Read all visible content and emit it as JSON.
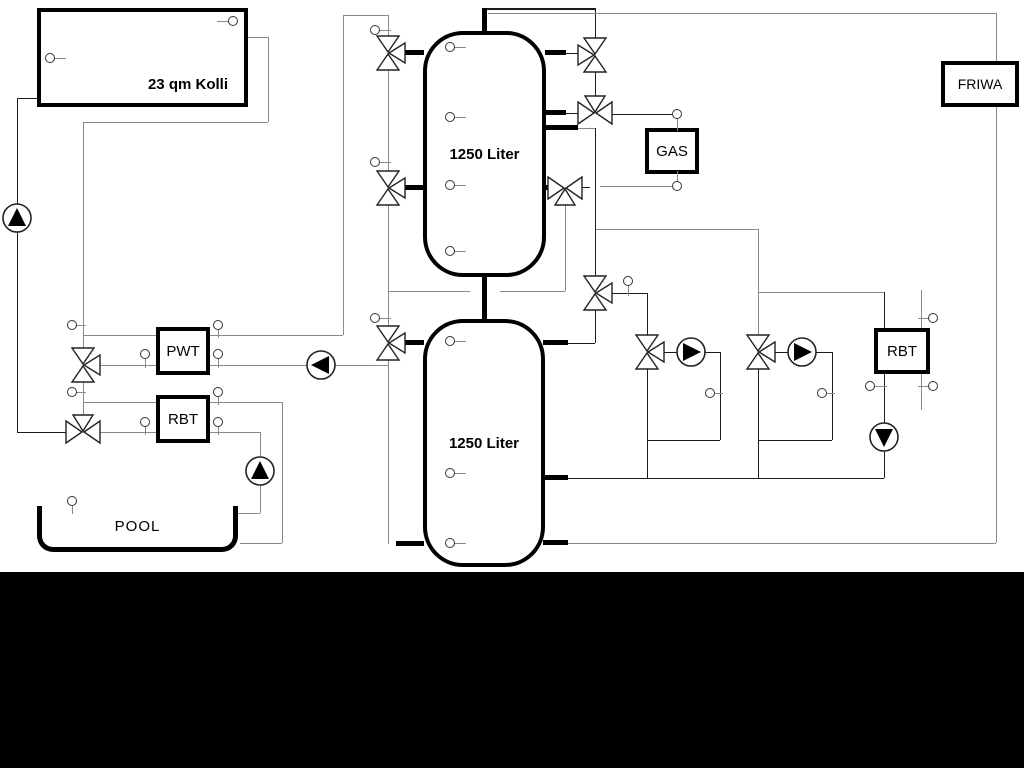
{
  "labels": {
    "collector": "23 qm Kolli",
    "tank_top": "1250 Liter",
    "tank_bottom": "1250 Liter",
    "gas": "GAS",
    "friwa": "FRIWA",
    "pwt": "PWT",
    "rbt_left": "RBT",
    "rbt_right": "RBT",
    "pool": "POOL"
  },
  "colors": {
    "line_black": "#1c1c1c",
    "line_gray": "#8a8a8a",
    "stub_black": "#000000",
    "background": "#ffffff",
    "letterbox": "#000000"
  },
  "diagram": {
    "lines": [
      {
        "n": "collector-flow-pipe",
        "x": 17,
        "y": 98,
        "len": 20,
        "o": "h",
        "c": "k"
      },
      {
        "n": "collector-flow-pipe",
        "x": 17,
        "y": 98,
        "len": 334,
        "o": "v",
        "c": "k"
      },
      {
        "n": "collector-flow-pipe",
        "x": 17,
        "y": 432,
        "len": 49,
        "o": "h",
        "c": "k"
      },
      {
        "n": "collector-return-pipe",
        "x": 248,
        "y": 37,
        "len": 20,
        "o": "h",
        "c": "g"
      },
      {
        "n": "collector-return-pipe",
        "x": 268,
        "y": 37,
        "len": 85,
        "o": "v",
        "c": "g"
      },
      {
        "n": "collector-return-pipe",
        "x": 83,
        "y": 122,
        "len": 185,
        "o": "h",
        "c": "g"
      },
      {
        "n": "collector-return-pipe",
        "x": 83,
        "y": 122,
        "len": 227,
        "o": "v",
        "c": "g"
      },
      {
        "n": "left-riser-pipe",
        "x": 83,
        "y": 381,
        "len": 35,
        "o": "v",
        "c": "g"
      },
      {
        "n": "pwt-top-pipe",
        "x": 83,
        "y": 335,
        "len": 73,
        "o": "h",
        "c": "g"
      },
      {
        "n": "pwt-top-pipe",
        "x": 210,
        "y": 335,
        "len": 133,
        "o": "h",
        "c": "g"
      },
      {
        "n": "solar-to-tank-pipe",
        "x": 343,
        "y": 15,
        "len": 320,
        "o": "v",
        "c": "g"
      },
      {
        "n": "solar-to-tank-pipe",
        "x": 343,
        "y": 15,
        "len": 45,
        "o": "h",
        "c": "g"
      },
      {
        "n": "pwt-bottom-pipe",
        "x": 99,
        "y": 365,
        "len": 57,
        "o": "h",
        "c": "g"
      },
      {
        "n": "pwt-bottom-pipe",
        "x": 210,
        "y": 365,
        "len": 97,
        "o": "h",
        "c": "g"
      },
      {
        "n": "pwt-bottom-pipe",
        "x": 335,
        "y": 365,
        "len": 53,
        "o": "h",
        "c": "g"
      },
      {
        "n": "rbt-top-pipe",
        "x": 83,
        "y": 402,
        "len": 73,
        "o": "h",
        "c": "g"
      },
      {
        "n": "rbt-top-pipe",
        "x": 210,
        "y": 402,
        "len": 72,
        "o": "h",
        "c": "g"
      },
      {
        "n": "pool-return-pipe",
        "x": 282,
        "y": 402,
        "len": 141,
        "o": "v",
        "c": "g"
      },
      {
        "n": "pool-return-pipe",
        "x": 240,
        "y": 543,
        "len": 42,
        "o": "h",
        "c": "g"
      },
      {
        "n": "rbt-bottom-pipe",
        "x": 99,
        "y": 432,
        "len": 57,
        "o": "h",
        "c": "g"
      },
      {
        "n": "rbt-bottom-pipe",
        "x": 210,
        "y": 432,
        "len": 50,
        "o": "h",
        "c": "g"
      },
      {
        "n": "pool-supply-pipe",
        "x": 260,
        "y": 432,
        "len": 81,
        "o": "v",
        "c": "g"
      },
      {
        "n": "pool-supply-pipe",
        "x": 238,
        "y": 513,
        "len": 22,
        "o": "h",
        "c": "g"
      },
      {
        "n": "tank-left-riser",
        "x": 388,
        "y": 15,
        "len": 22,
        "o": "v",
        "c": "g"
      },
      {
        "n": "tank-left-riser",
        "x": 388,
        "y": 69,
        "len": 103,
        "o": "v",
        "c": "g"
      },
      {
        "n": "tank-left-riser",
        "x": 388,
        "y": 204,
        "len": 123,
        "o": "v",
        "c": "g"
      },
      {
        "n": "tank-left-riser",
        "x": 388,
        "y": 359,
        "len": 185,
        "o": "v",
        "c": "g"
      },
      {
        "n": "inter-tank-pipe",
        "x": 388,
        "y": 291,
        "len": 82,
        "o": "h",
        "c": "g"
      },
      {
        "n": "inter-tank-pipe",
        "x": 500,
        "y": 291,
        "len": 65,
        "o": "h",
        "c": "g"
      },
      {
        "n": "gas-return-riser",
        "x": 565,
        "y": 205,
        "len": 86,
        "o": "v",
        "c": "g"
      },
      {
        "n": "tank-top-pipe",
        "x": 484,
        "y": 9,
        "len": 112,
        "o": "h",
        "c": "k",
        "t": 2
      },
      {
        "n": "tank-top-pipe",
        "x": 595,
        "y": 10,
        "len": 28,
        "o": "v",
        "c": "k"
      },
      {
        "n": "friwa-supply-pipe",
        "x": 488,
        "y": 13,
        "len": 508,
        "o": "h",
        "c": "g"
      },
      {
        "n": "friwa-supply-pipe",
        "x": 996,
        "y": 13,
        "len": 48,
        "o": "v",
        "c": "g"
      },
      {
        "n": "friwa-return-pipe",
        "x": 996,
        "y": 107,
        "len": 436,
        "o": "v",
        "c": "g"
      },
      {
        "n": "friwa-return-pipe",
        "x": 567,
        "y": 543,
        "len": 429,
        "o": "h",
        "c": "g"
      },
      {
        "n": "valve-port-pipe",
        "x": 566,
        "y": 53,
        "len": 12,
        "o": "h",
        "c": "k"
      },
      {
        "n": "right-valve-riser",
        "x": 595,
        "y": 72,
        "len": 25,
        "o": "v",
        "c": "k"
      },
      {
        "n": "valve-port-pipe",
        "x": 566,
        "y": 113,
        "len": 12,
        "o": "h",
        "c": "k"
      },
      {
        "n": "gas-supply-pipe",
        "x": 612,
        "y": 114,
        "len": 60,
        "o": "h",
        "c": "k"
      },
      {
        "n": "gas-return-pipe",
        "x": 582,
        "y": 187,
        "len": 8,
        "o": "h",
        "c": "k"
      },
      {
        "n": "gas-return-pipe",
        "x": 600,
        "y": 186,
        "len": 72,
        "o": "h",
        "c": "g"
      },
      {
        "n": "tank2-supply-riser",
        "x": 595,
        "y": 128,
        "len": 149,
        "o": "v",
        "c": "k"
      },
      {
        "n": "tank2-supply-riser",
        "x": 578,
        "y": 128,
        "len": 17,
        "o": "h",
        "c": "g"
      },
      {
        "n": "heating-branch-pipe",
        "x": 596,
        "y": 229,
        "len": 162,
        "o": "h",
        "c": "g"
      },
      {
        "n": "heating-branch-pipe",
        "x": 758,
        "y": 229,
        "len": 107,
        "o": "v",
        "c": "g"
      },
      {
        "n": "rbt2-supply-pipe",
        "x": 758,
        "y": 292,
        "len": 126,
        "o": "h",
        "c": "g"
      },
      {
        "n": "rbt2-riser",
        "x": 884,
        "y": 292,
        "len": 186,
        "o": "v",
        "c": "k"
      },
      {
        "n": "tank2-supply-pipe",
        "x": 595,
        "y": 309,
        "len": 34,
        "o": "v",
        "c": "k"
      },
      {
        "n": "tank2-supply-pipe",
        "x": 567,
        "y": 343,
        "len": 28,
        "o": "h",
        "c": "k"
      },
      {
        "n": "heating1-supply-pipe",
        "x": 612,
        "y": 293,
        "len": 35,
        "o": "h",
        "c": "k"
      },
      {
        "n": "heating1-supply-pipe",
        "x": 647,
        "y": 293,
        "len": 43,
        "o": "v",
        "c": "k"
      },
      {
        "n": "pump1-inlet-pipe",
        "x": 664,
        "y": 352,
        "len": 13,
        "o": "h",
        "c": "k"
      },
      {
        "n": "pump1-outlet-pipe",
        "x": 705,
        "y": 352,
        "len": 15,
        "o": "h",
        "c": "k"
      },
      {
        "n": "pump1-loop-pipe",
        "x": 720,
        "y": 352,
        "len": 88,
        "o": "v",
        "c": "k"
      },
      {
        "n": "pump1-loop-pipe",
        "x": 647,
        "y": 440,
        "len": 73,
        "o": "h",
        "c": "k"
      },
      {
        "n": "heating1-return-riser",
        "x": 647,
        "y": 368,
        "len": 110,
        "o": "v",
        "c": "k"
      },
      {
        "n": "pump2-inlet-pipe",
        "x": 775,
        "y": 352,
        "len": 13,
        "o": "h",
        "c": "k"
      },
      {
        "n": "pump2-outlet-pipe",
        "x": 816,
        "y": 352,
        "len": 16,
        "o": "h",
        "c": "k"
      },
      {
        "n": "pump2-loop-pipe",
        "x": 832,
        "y": 352,
        "len": 88,
        "o": "v",
        "c": "k"
      },
      {
        "n": "pump2-loop-pipe",
        "x": 758,
        "y": 440,
        "len": 74,
        "o": "h",
        "c": "k"
      },
      {
        "n": "heating2-return-riser",
        "x": 758,
        "y": 368,
        "len": 110,
        "o": "v",
        "c": "k"
      },
      {
        "n": "tank2-return-pipe",
        "x": 567,
        "y": 478,
        "len": 317,
        "o": "h",
        "c": "k"
      },
      {
        "n": "friwa-cold-pipe",
        "x": 921,
        "y": 290,
        "len": 120,
        "o": "v",
        "c": "g"
      }
    ],
    "stubs": [
      {
        "n": "tank1-stub",
        "x": 403,
        "y": 50,
        "w": 21,
        "h": 5
      },
      {
        "n": "tank1-stub",
        "x": 403,
        "y": 185,
        "w": 21,
        "h": 5
      },
      {
        "n": "tank1-stub",
        "x": 545,
        "y": 50,
        "w": 21,
        "h": 5
      },
      {
        "n": "tank1-stub",
        "x": 545,
        "y": 110,
        "w": 21,
        "h": 5
      },
      {
        "n": "tank1-stub",
        "x": 545,
        "y": 125,
        "w": 33,
        "h": 5
      },
      {
        "n": "tank1-stub",
        "x": 545,
        "y": 185,
        "w": 11,
        "h": 5
      },
      {
        "n": "tank1-top-stub",
        "x": 482,
        "y": 8,
        "w": 5,
        "h": 26
      },
      {
        "n": "tank-connector-stub",
        "x": 482,
        "y": 275,
        "w": 5,
        "h": 46
      },
      {
        "n": "tank2-stub",
        "x": 402,
        "y": 340,
        "w": 22,
        "h": 5
      },
      {
        "n": "tank2-stub",
        "x": 396,
        "y": 541,
        "w": 28,
        "h": 5
      },
      {
        "n": "tank2-stub",
        "x": 543,
        "y": 340,
        "w": 25,
        "h": 5
      },
      {
        "n": "tank2-stub",
        "x": 543,
        "y": 475,
        "w": 25,
        "h": 5
      },
      {
        "n": "tank2-stub",
        "x": 543,
        "y": 540,
        "w": 25,
        "h": 5
      }
    ],
    "valves": [
      {
        "n": "tank1-left-top-valve",
        "x": 388,
        "y": 53,
        "type": "v-right"
      },
      {
        "n": "tank1-left-mid-valve",
        "x": 388,
        "y": 188,
        "type": "v-right"
      },
      {
        "n": "tank2-left-valve",
        "x": 388,
        "y": 343,
        "type": "v-right"
      },
      {
        "n": "pwt-supply-valve",
        "x": 83,
        "y": 365,
        "type": "v-right"
      },
      {
        "n": "pool-supply-valve",
        "x": 83,
        "y": 432,
        "type": "h-top"
      },
      {
        "n": "tank1-right-top-valve",
        "x": 595,
        "y": 55,
        "type": "v-left"
      },
      {
        "n": "gas-supply-valve",
        "x": 595,
        "y": 113,
        "type": "h-top"
      },
      {
        "n": "gas-return-valve",
        "x": 565,
        "y": 188,
        "type": "h-bottom"
      },
      {
        "n": "tank2-supply-valve",
        "x": 595,
        "y": 293,
        "type": "v-right"
      },
      {
        "n": "heating-valve-1",
        "x": 647,
        "y": 352,
        "type": "v-right"
      },
      {
        "n": "heating-valve-2",
        "x": 758,
        "y": 352,
        "type": "v-right"
      }
    ],
    "pumps": [
      {
        "n": "solar-pump",
        "x": 17,
        "y": 218,
        "dir": "up"
      },
      {
        "n": "pwt-pump",
        "x": 321,
        "y": 365,
        "dir": "left"
      },
      {
        "n": "pool-pump",
        "x": 260,
        "y": 471,
        "dir": "up"
      },
      {
        "n": "heating-pump-1",
        "x": 691,
        "y": 352,
        "dir": "right"
      },
      {
        "n": "heating-pump-2",
        "x": 802,
        "y": 352,
        "dir": "right"
      },
      {
        "n": "rbt-return-pump",
        "x": 884,
        "y": 437,
        "dir": "down"
      }
    ],
    "sensors": [
      {
        "n": "collector-sensor",
        "x": 50,
        "y": 58,
        "stem": "r",
        "len": 8
      },
      {
        "n": "collector-sensor",
        "x": 233,
        "y": 21,
        "stem": "l",
        "len": 8
      },
      {
        "n": "riser-sensor",
        "x": 72,
        "y": 325,
        "stem": "r",
        "len": 6
      },
      {
        "n": "pwt-sensor",
        "x": 218,
        "y": 325,
        "stem": "d",
        "len": 5
      },
      {
        "n": "pwt-sensor",
        "x": 145,
        "y": 354,
        "stem": "d",
        "len": 6
      },
      {
        "n": "pwt-sensor",
        "x": 218,
        "y": 354,
        "stem": "d",
        "len": 6
      },
      {
        "n": "riser-sensor",
        "x": 72,
        "y": 392,
        "stem": "r",
        "len": 6
      },
      {
        "n": "rbt-sensor",
        "x": 218,
        "y": 392,
        "stem": "d",
        "len": 5
      },
      {
        "n": "rbt-sensor",
        "x": 145,
        "y": 422,
        "stem": "d",
        "len": 5
      },
      {
        "n": "rbt-sensor",
        "x": 218,
        "y": 422,
        "stem": "d",
        "len": 5
      },
      {
        "n": "pool-sensor",
        "x": 72,
        "y": 501,
        "stem": "d",
        "len": 5
      },
      {
        "n": "riser-sensor",
        "x": 375,
        "y": 30,
        "stem": "r",
        "len": 8
      },
      {
        "n": "riser-sensor",
        "x": 375,
        "y": 162,
        "stem": "r",
        "len": 8
      },
      {
        "n": "riser-sensor",
        "x": 375,
        "y": 318,
        "stem": "r",
        "len": 8
      },
      {
        "n": "tank1-sensor",
        "x": 450,
        "y": 47,
        "stem": "r",
        "len": 8
      },
      {
        "n": "tank1-sensor",
        "x": 450,
        "y": 117,
        "stem": "r",
        "len": 8
      },
      {
        "n": "tank1-sensor",
        "x": 450,
        "y": 185,
        "stem": "r",
        "len": 8
      },
      {
        "n": "tank1-sensor",
        "x": 450,
        "y": 251,
        "stem": "r",
        "len": 8
      },
      {
        "n": "tank2-sensor",
        "x": 450,
        "y": 341,
        "stem": "r",
        "len": 8
      },
      {
        "n": "tank2-sensor",
        "x": 450,
        "y": 473,
        "stem": "r",
        "len": 8
      },
      {
        "n": "tank2-sensor",
        "x": 450,
        "y": 543,
        "stem": "r",
        "len": 8
      },
      {
        "n": "valve-sensor",
        "x": 628,
        "y": 281,
        "stem": "d",
        "len": 7
      },
      {
        "n": "gas-top-sensor",
        "x": 677,
        "y": 114,
        "stem": "d",
        "len": 9
      },
      {
        "n": "gas-bottom-sensor",
        "x": 677,
        "y": 186,
        "stem": "u",
        "len": 7
      },
      {
        "n": "heating1-sensor",
        "x": 710,
        "y": 393,
        "stem": "r",
        "len": 5
      },
      {
        "n": "heating2-sensor",
        "x": 822,
        "y": 393,
        "stem": "r",
        "len": 5
      },
      {
        "n": "rbt2-sensor",
        "x": 870,
        "y": 386,
        "stem": "r",
        "len": 9
      },
      {
        "n": "friwa-cold-sensor",
        "x": 933,
        "y": 318,
        "stem": "l",
        "len": 7
      },
      {
        "n": "friwa-cold-sensor",
        "x": 933,
        "y": 386,
        "stem": "l",
        "len": 7
      }
    ]
  }
}
